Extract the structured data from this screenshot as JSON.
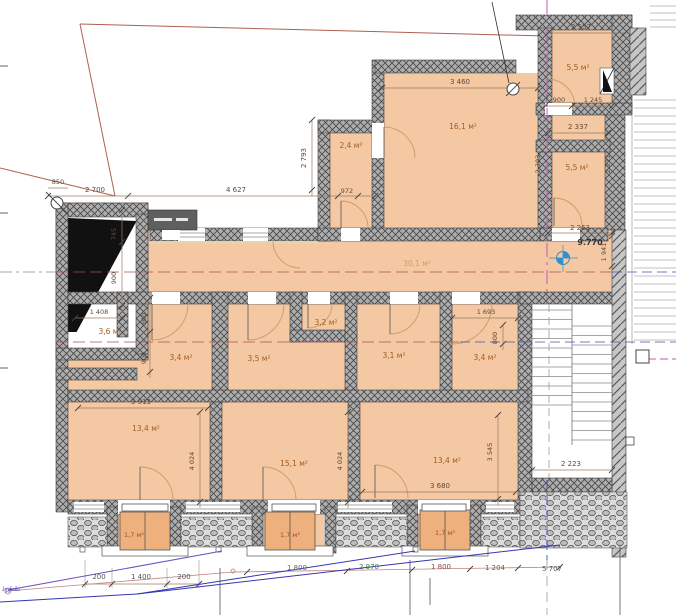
{
  "rooms": {
    "r55a": "5,5 м²",
    "r55b": "5,5 м²",
    "r161": "16,1 м²",
    "r24": "2,4 м²",
    "r301": "30,1 м²",
    "r36": "3,6 м²",
    "r34a": "3,4 м²",
    "r35": "3,5 м²",
    "r32": "3,2 м²",
    "r31": "3,1 м²",
    "r34b": "3,4 м²",
    "r134a": "13,4 м²",
    "r151": "15,1 м²",
    "r134b": "13,4 м²",
    "b1": "1,7 м²",
    "b2": "1,7 м²",
    "b3": "1,7 м²"
  },
  "levels": {
    "elevation": "9.770"
  },
  "dims": {
    "d850": "850",
    "d2700": "2 700",
    "d4627": "4 627",
    "d2793": "2 793",
    "d972": "972",
    "d3460": "3 460",
    "d2557": "2 557",
    "d900a": "900",
    "d1245": "1 245",
    "d2337": "2 337",
    "d2303": "2 303",
    "d2271": "2 271",
    "d2263": "2 263",
    "d1941": "1 941",
    "d745": "745",
    "d900b": "900",
    "d1408": "1 408",
    "d800a": "800",
    "d900c": "900",
    "d1693": "1 693",
    "d800b": "800",
    "d3913": "3 913",
    "d4024a": "4 024",
    "d4024b": "4 024",
    "d3545": "3 545",
    "d3680": "3 680",
    "d2223": "2 223",
    "d200a": "200",
    "d1400": "1 400",
    "d200b": "200",
    "d1800a": "1 800",
    "d2970": "2 970",
    "d1800b": "1 800",
    "d1204": "1 204",
    "d5707": "5 707"
  },
  "annotations": {
    "note": "ჰევნიშა"
  },
  "colors": {
    "room_fill": "#f4c8a3",
    "wall": "#adadad",
    "boundary": "#b05f4f",
    "axis_red": "#a85050",
    "axis_blue": "#4050b8",
    "axis_magenta": "#c258b8",
    "marker_blue": "#2f8fd0",
    "dim_green": "#3f7d3f",
    "dim_brown": "#8a4a3a"
  }
}
